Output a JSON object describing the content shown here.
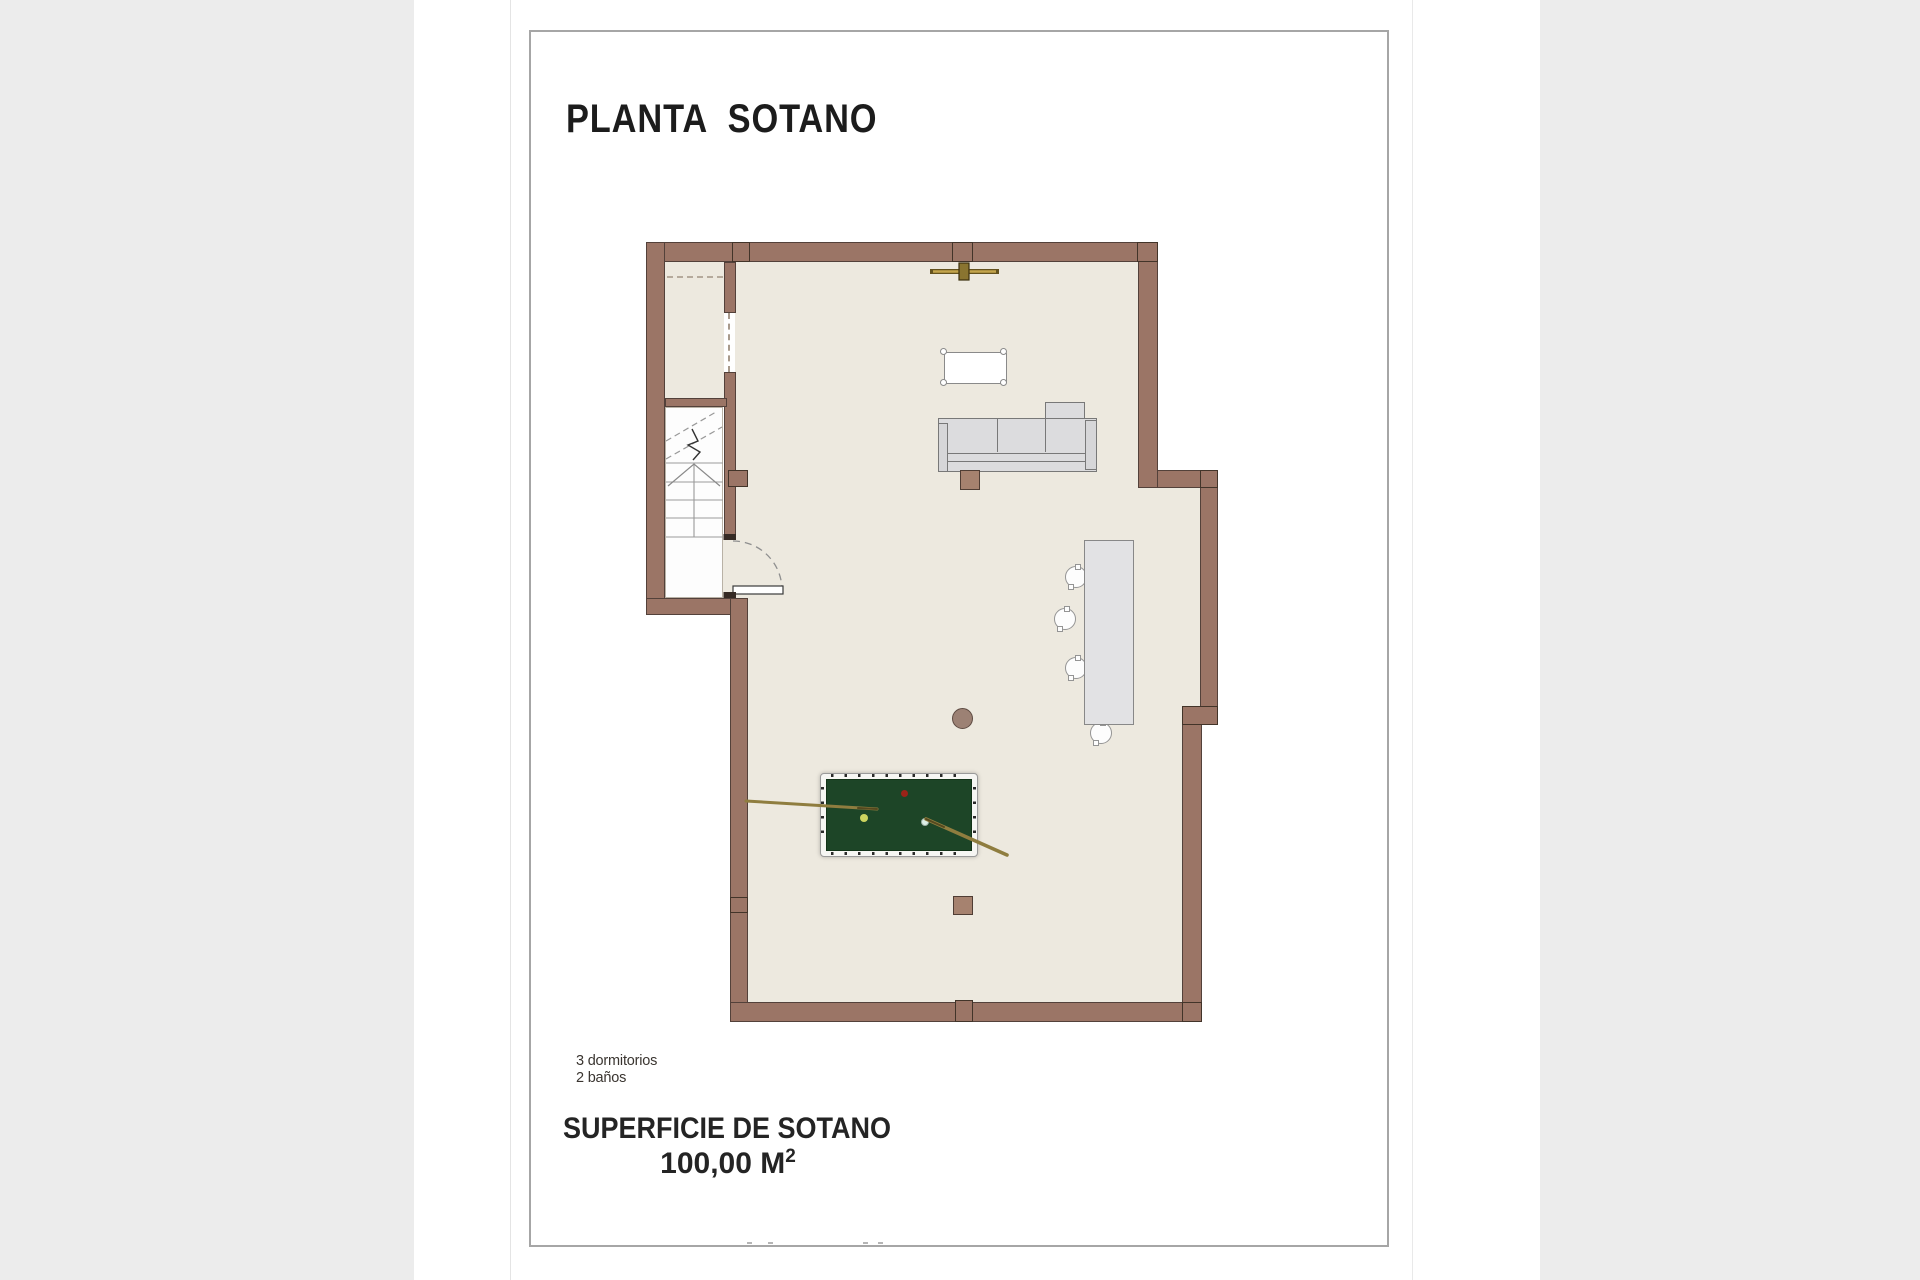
{
  "document": {
    "title": "PLANTA  SOTANO",
    "notes": [
      "3 dormitorios",
      "2 baños"
    ],
    "area_label": "SUPERFICIE DE SOTANO",
    "area_value": "100,00 M",
    "area_superscript": "2"
  },
  "plan": {
    "type": "architectural-floor-plan",
    "floor_shown": "basement",
    "features": [
      "stairwell",
      "storage-closet",
      "entry-door",
      "ceiling-fan",
      "coffee-table",
      "sofa-sectional",
      "bar-counter",
      "four-stools",
      "round-column",
      "square-columns",
      "pool-table",
      "two-billiard-cues",
      "three-billiard-balls"
    ]
  },
  "colors": {
    "page_margin": "#ececec",
    "page": "#ffffff",
    "frame_border": "#a6a6a6",
    "wall_fill": "#9b7566",
    "wall_outline": "#53413a",
    "floor": "#ede9df",
    "stairwell_floor": "#fdfdfd",
    "pool_felt": "#1d4527",
    "cue_wood": "#8f7d3f",
    "fan_gold": "#c3a44c",
    "ball_red": "#9b2318",
    "ball_yellow": "#ccd45f",
    "ball_white": "#dcefe6"
  }
}
